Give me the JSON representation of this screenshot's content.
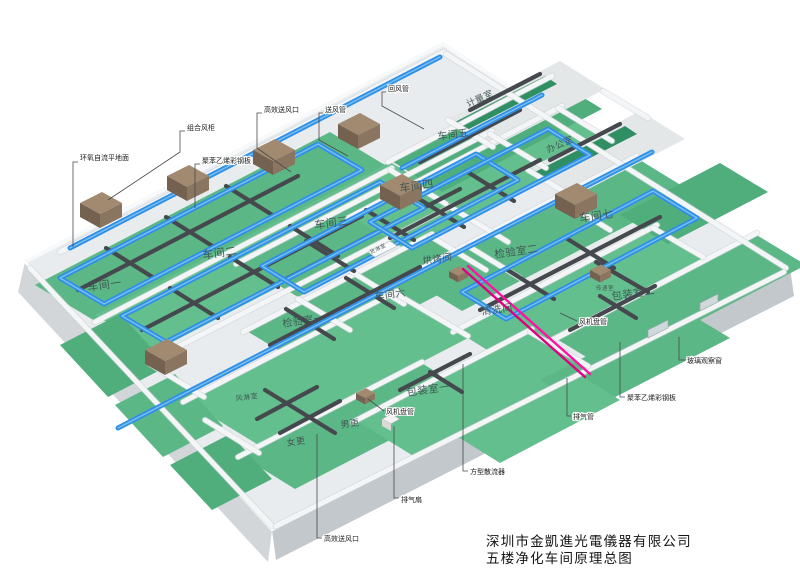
{
  "title_block": {
    "company": "深圳市金凱進光電儀器有限公司",
    "drawing_title": "五楼净化车间原理总图"
  },
  "rooms": [
    {
      "id": "workshop-1",
      "label": "车间一"
    },
    {
      "id": "workshop-2",
      "label": "车间二"
    },
    {
      "id": "workshop-3",
      "label": "车间三"
    },
    {
      "id": "workshop-4",
      "label": "车间四"
    },
    {
      "id": "workshop-5",
      "label": "车间五"
    },
    {
      "id": "workshop-6",
      "label": "车间六"
    },
    {
      "id": "workshop-7",
      "label": "车间七"
    },
    {
      "id": "inspection-room-1",
      "label": "检验室一"
    },
    {
      "id": "inspection-room-2",
      "label": "检验室二"
    },
    {
      "id": "packing-room-1",
      "label": "包装室一"
    },
    {
      "id": "packing-room-2",
      "label": "包装室二"
    },
    {
      "id": "baking-room",
      "label": "烘烤间"
    },
    {
      "id": "cleaning-room",
      "label": "清洗间"
    },
    {
      "id": "cargo-shower-room",
      "label": "货淋室"
    },
    {
      "id": "air-shower-room",
      "label": "风淋室"
    },
    {
      "id": "women-changing-room",
      "label": "女更"
    },
    {
      "id": "men-changing-room",
      "label": "男更"
    },
    {
      "id": "metrology-room",
      "label": "计量室"
    },
    {
      "id": "office",
      "label": "办公室"
    },
    {
      "id": "pass-through-room",
      "label": "传递室"
    }
  ],
  "annotations": [
    {
      "id": "epoxy-self-leveling-floor",
      "label": "环氧自流平地面"
    },
    {
      "id": "combined-air-handling-unit",
      "label": "组合风柜"
    },
    {
      "id": "polystyrene-steel-panel-left",
      "label": "聚苯乙烯彩钢板"
    },
    {
      "id": "hepa-supply-outlet-top",
      "label": "高效送风口"
    },
    {
      "id": "supply-air-duct",
      "label": "送风管"
    },
    {
      "id": "return-air-duct",
      "label": "回风管"
    },
    {
      "id": "fan-coil-unit-bottom",
      "label": "风机盘管"
    },
    {
      "id": "exhaust-fan",
      "label": "排气扇"
    },
    {
      "id": "square-diffuser",
      "label": "方型散流器"
    },
    {
      "id": "hepa-supply-outlet-bottom",
      "label": "高效送风口"
    },
    {
      "id": "exhaust-pipe",
      "label": "排气管"
    },
    {
      "id": "fan-coil-unit-right",
      "label": "风机盘管"
    },
    {
      "id": "polystyrene-steel-panel-right",
      "label": "聚苯乙烯彩钢板"
    },
    {
      "id": "glass-observation-window",
      "label": "玻璃观察窗"
    }
  ],
  "colors": {
    "floor_green": "#5cb786",
    "floor_green_alt": "#63bf8d",
    "floor_green_dark": "#4fae7c",
    "accent_green_strip": "#2f8f63",
    "duct_blue": "#2e90e6",
    "duct_blue_highlight": "#85c4f2",
    "duct_dark": "#45494d",
    "ahu_top": "#a18a70",
    "ahu_front": "#756150",
    "ahu_side": "#8a7560",
    "exhaust_pink": "#ff12a0",
    "exhaust_pink_dark": "#e00080",
    "slab_top": "#e9ecee",
    "slab_left": "#d2d6d9",
    "slab_right": "#c3c8cc",
    "wall_white": "#f3f5f6"
  }
}
